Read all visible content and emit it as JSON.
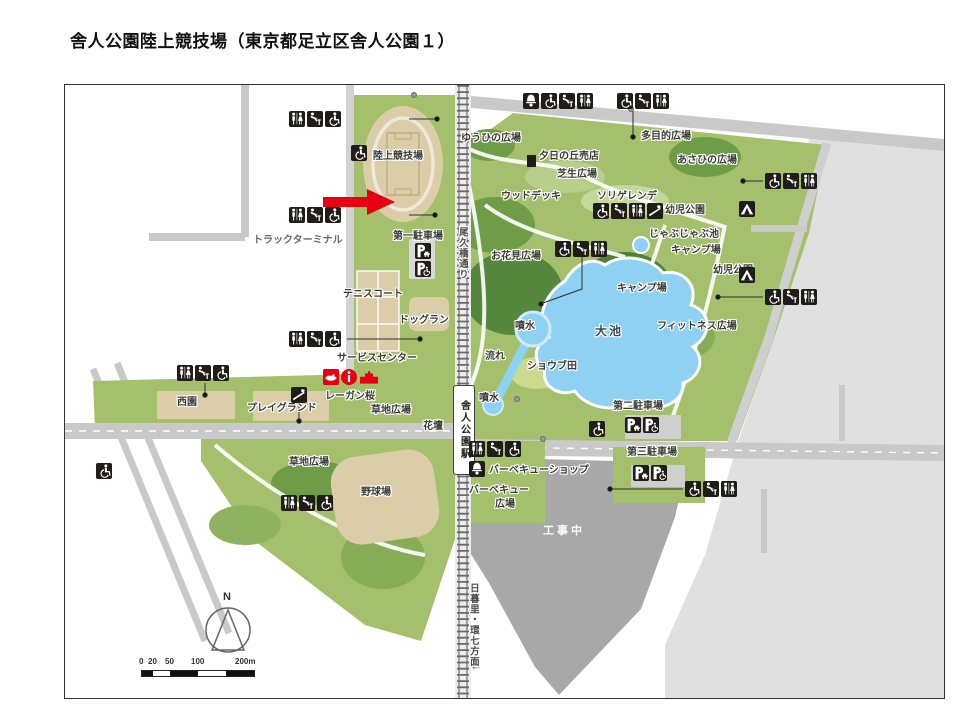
{
  "page": {
    "title": "舎人公園陸上競技場（東京都足立区舎人公園１）"
  },
  "map": {
    "station": {
      "name": "舎人公園駅"
    },
    "compass": {
      "north": "N"
    },
    "scale": {
      "ticks": [
        "0",
        "20",
        "50",
        "100",
        "200m"
      ]
    },
    "labels": [
      {
        "t": "陸上競技場",
        "x": 308,
        "y": 66
      },
      {
        "t": "ゆうひの広場",
        "x": 396,
        "y": 48
      },
      {
        "t": "夕日の丘売店",
        "x": 474,
        "y": 66
      },
      {
        "t": "多目的広場",
        "x": 576,
        "y": 46
      },
      {
        "t": "芝生広場",
        "x": 492,
        "y": 84
      },
      {
        "t": "あさひの広場",
        "x": 612,
        "y": 70
      },
      {
        "t": "ウッドデッキ",
        "x": 436,
        "y": 106
      },
      {
        "t": "ソリゲレンデ",
        "x": 532,
        "y": 106
      },
      {
        "t": "幼児公園",
        "x": 600,
        "y": 120
      },
      {
        "t": "じゃぶじゃぶ池",
        "x": 584,
        "y": 144
      },
      {
        "t": "キャンプ場",
        "x": 606,
        "y": 160
      },
      {
        "t": "幼児公園",
        "x": 648,
        "y": 180
      },
      {
        "t": "キャンプ場",
        "x": 552,
        "y": 198
      },
      {
        "t": "フィットネス広場",
        "x": 592,
        "y": 236
      },
      {
        "t": "お花見広場",
        "x": 426,
        "y": 166
      },
      {
        "t": "トラックターミナル",
        "x": 188,
        "y": 150,
        "c": "muted"
      },
      {
        "t": "第一駐車場",
        "x": 328,
        "y": 146
      },
      {
        "t": "テニスコート",
        "x": 278,
        "y": 204
      },
      {
        "t": "ドッグラン",
        "x": 334,
        "y": 230
      },
      {
        "t": "サービスセンター",
        "x": 272,
        "y": 268
      },
      {
        "t": "レーガン桜",
        "x": 260,
        "y": 306
      },
      {
        "t": "草地広場",
        "x": 306,
        "y": 320
      },
      {
        "t": "花壇",
        "x": 358,
        "y": 336
      },
      {
        "t": "西園",
        "x": 112,
        "y": 312
      },
      {
        "t": "プレイグランド",
        "x": 182,
        "y": 318
      },
      {
        "t": "草地広場",
        "x": 224,
        "y": 372
      },
      {
        "t": "野球場",
        "x": 296,
        "y": 402
      },
      {
        "t": "バーベキューショップ",
        "x": 424,
        "y": 380
      },
      {
        "t": "バーベキュー",
        "x": 404,
        "y": 400
      },
      {
        "t": "広場",
        "x": 430,
        "y": 414
      },
      {
        "t": "第二駐車場",
        "x": 548,
        "y": 316
      },
      {
        "t": "第三駐車場",
        "x": 562,
        "y": 362
      },
      {
        "t": "工事中",
        "x": 478,
        "y": 440,
        "c": "white"
      },
      {
        "t": "大池",
        "x": 530,
        "y": 240,
        "c": "big"
      },
      {
        "t": "噴水",
        "x": 450,
        "y": 236
      },
      {
        "t": "噴水",
        "x": 414,
        "y": 308
      },
      {
        "t": "流れ",
        "x": 420,
        "y": 266
      },
      {
        "t": "ショウブ田",
        "x": 462,
        "y": 276
      },
      {
        "t": "尾久橋通り",
        "x": 391,
        "y": 142,
        "c": "vert"
      },
      {
        "t": "日暮里・環七方面",
        "x": 402,
        "y": 498,
        "c": "vert"
      },
      {
        "t": "↓",
        "x": 404,
        "y": 580,
        "c": "vert arrow"
      }
    ],
    "markers": [
      {
        "x": 224,
        "y": 26,
        "icons": [
          "toilet",
          "water-fountain",
          "accessible-toilet"
        ]
      },
      {
        "x": 224,
        "y": 122,
        "icons": [
          "toilet",
          "water-fountain",
          "accessible-toilet"
        ]
      },
      {
        "x": 286,
        "y": 60,
        "icons": [
          "accessible-toilet"
        ]
      },
      {
        "x": 458,
        "y": 8,
        "icons": [
          "shop",
          "accessible-toilet",
          "water-fountain",
          "toilet"
        ]
      },
      {
        "x": 552,
        "y": 8,
        "icons": [
          "accessible-toilet",
          "water-fountain",
          "toilet"
        ]
      },
      {
        "x": 528,
        "y": 118,
        "icons": [
          "accessible-toilet",
          "water-fountain",
          "toilet",
          "slope"
        ]
      },
      {
        "x": 700,
        "y": 88,
        "icons": [
          "accessible-toilet",
          "water-fountain",
          "toilet"
        ]
      },
      {
        "x": 700,
        "y": 204,
        "icons": [
          "accessible-toilet",
          "water-fountain",
          "toilet"
        ]
      },
      {
        "x": 674,
        "y": 116,
        "icons": [
          "tent"
        ]
      },
      {
        "x": 674,
        "y": 182,
        "icons": [
          "tent"
        ]
      },
      {
        "x": 490,
        "y": 156,
        "icons": [
          "accessible-toilet",
          "water-fountain",
          "toilet"
        ]
      },
      {
        "x": 224,
        "y": 246,
        "icons": [
          "toilet",
          "water-fountain",
          "accessible-toilet"
        ]
      },
      {
        "x": 258,
        "y": 284,
        "icons": [
          "park-emblem",
          "information",
          "service-building"
        ]
      },
      {
        "x": 226,
        "y": 302,
        "icons": [
          "playground"
        ]
      },
      {
        "x": 112,
        "y": 280,
        "icons": [
          "toilet",
          "water-fountain",
          "accessible-toilet"
        ]
      },
      {
        "x": 216,
        "y": 410,
        "icons": [
          "toilet",
          "water-fountain",
          "accessible-toilet"
        ]
      },
      {
        "x": 31,
        "y": 378,
        "icons": [
          "accessible-toilet"
        ]
      },
      {
        "x": 404,
        "y": 356,
        "icons": [
          "toilet",
          "water-fountain",
          "accessible-toilet"
        ]
      },
      {
        "x": 404,
        "y": 376,
        "icons": [
          "bbq-shop"
        ]
      },
      {
        "x": 560,
        "y": 332,
        "icons": [
          "parking",
          "accessible-parking"
        ]
      },
      {
        "x": 524,
        "y": 336,
        "icons": [
          "accessible-toilet"
        ]
      },
      {
        "x": 568,
        "y": 380,
        "icons": [
          "parking",
          "accessible-parking"
        ]
      },
      {
        "x": 620,
        "y": 396,
        "icons": [
          "accessible-toilet",
          "water-fountain",
          "toilet"
        ]
      },
      {
        "x": 350,
        "y": 158,
        "icons": [
          "parking",
          "accessible-parking"
        ],
        "dir": "v"
      }
    ]
  },
  "colors": {
    "base_green": "#a4c06c",
    "mid_green": "#7ea94c",
    "dark_green": "#55873c",
    "light_green": "#c4d89a",
    "pond_blue": "#8fd1f2",
    "tan": "#dbcda7",
    "road_gray": "#c9c9c9",
    "pale_gray": "#e0e0e0",
    "construction_gray": "#a8a8a8",
    "icon_black": "#201d18",
    "accent_red": "#e60012"
  }
}
